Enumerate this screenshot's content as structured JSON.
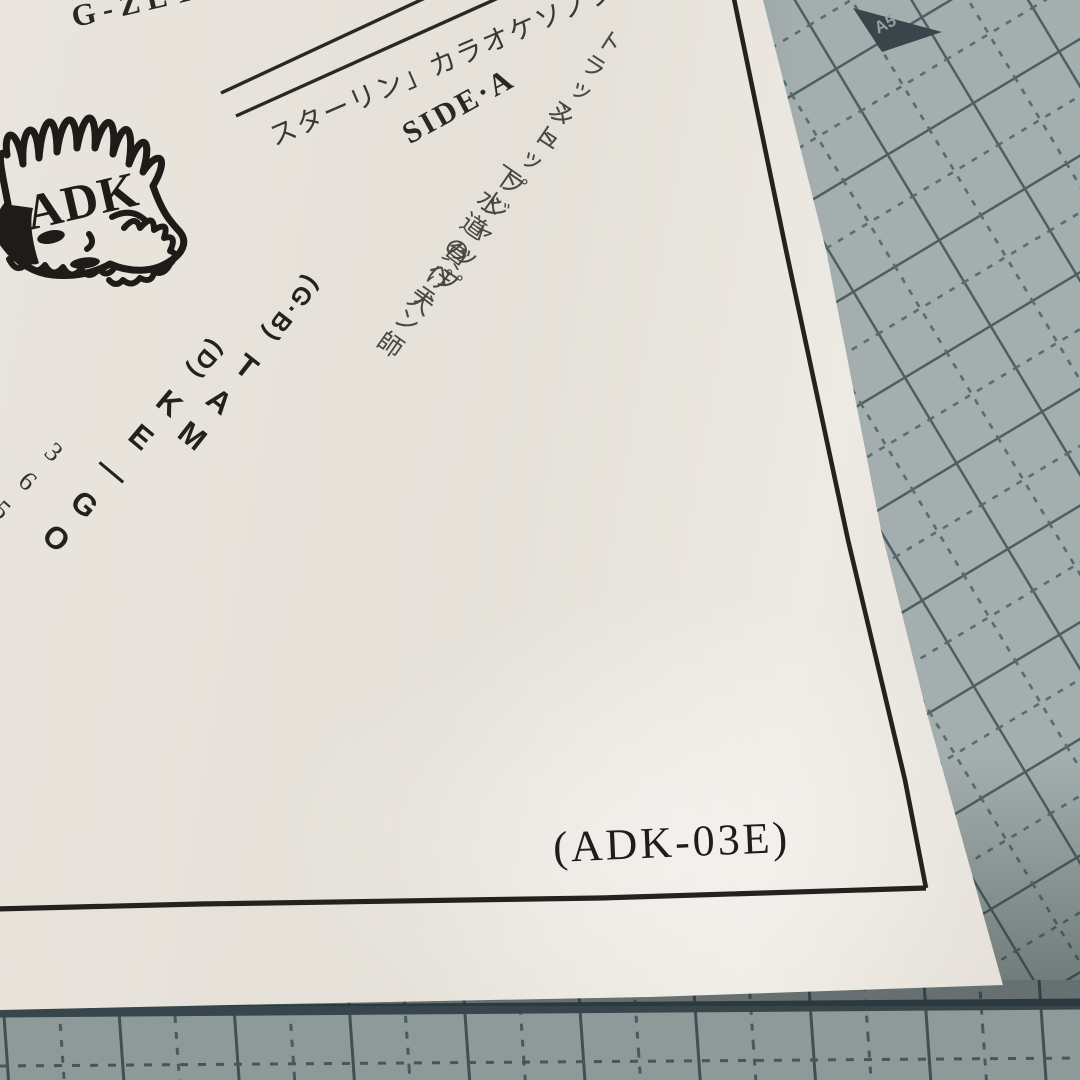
{
  "sleeve": {
    "band_name": "G-ZET",
    "logo_text": "ADK",
    "title_diagonal": "スターリン」カラオケソノシート",
    "side_label": "SIDE·A",
    "tracks": {
      "t1": "トラッシュ",
      "t2": "ストップジャップ",
      "t3": "下水道のペテン師",
      "t4": "負け犬",
      "t5": "365",
      "t6": "フィフティーン"
    },
    "credits": {
      "c1": {
        "role": "(G·B)",
        "name": "TAM"
      },
      "c2": {
        "role": "(D)",
        "name": "KE—GO"
      }
    },
    "catalog_number": "(ADK-03E)"
  },
  "mat": {
    "size_label": "A5",
    "surface_color": "#a4aeae",
    "line_color": "#4d5f61"
  },
  "colors": {
    "print_ink": "#23211e",
    "paper": "#e8e4dd"
  }
}
